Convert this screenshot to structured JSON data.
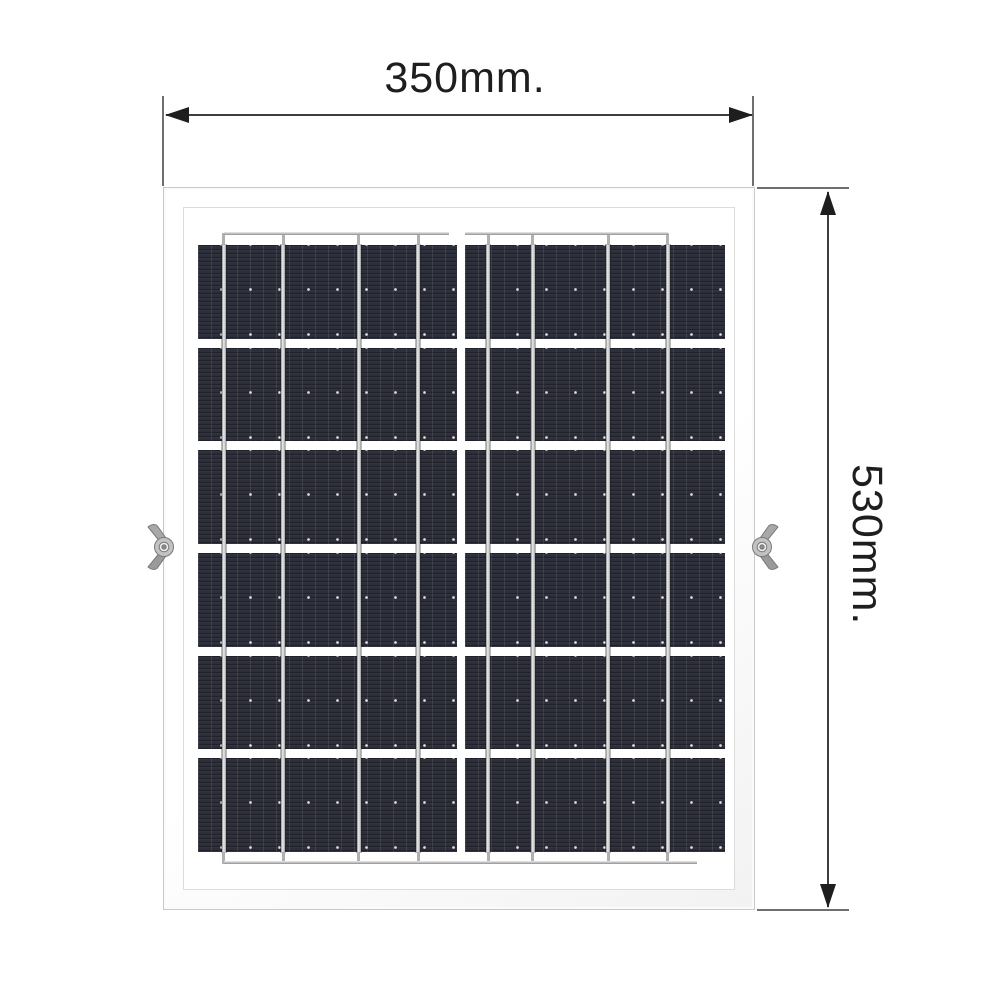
{
  "dimensions": {
    "width": {
      "label": "350mm."
    },
    "height": {
      "label": "530mm."
    }
  },
  "panel": {
    "rows": 6,
    "halves": 2,
    "busbars_per_half": 4,
    "left_busbar_pos_pct": [
      10,
      33,
      62,
      85
    ],
    "right_busbar_pos_pct": [
      9,
      26,
      55,
      78
    ]
  },
  "hardware": {
    "left_bracket": "wing-nut",
    "right_bracket": "wing-nut"
  },
  "colors": {
    "background": "#ffffff",
    "dimension_text": "#1e1e1e",
    "dimension_line": "#3d3d3d",
    "extension_line": "#6f6f6f",
    "cell_base": "#2c2e3a",
    "busbar_silver": "#f0f0f0",
    "frame_edge": "#c9c9c9",
    "wingnut_grey": "#a9a9a9"
  }
}
